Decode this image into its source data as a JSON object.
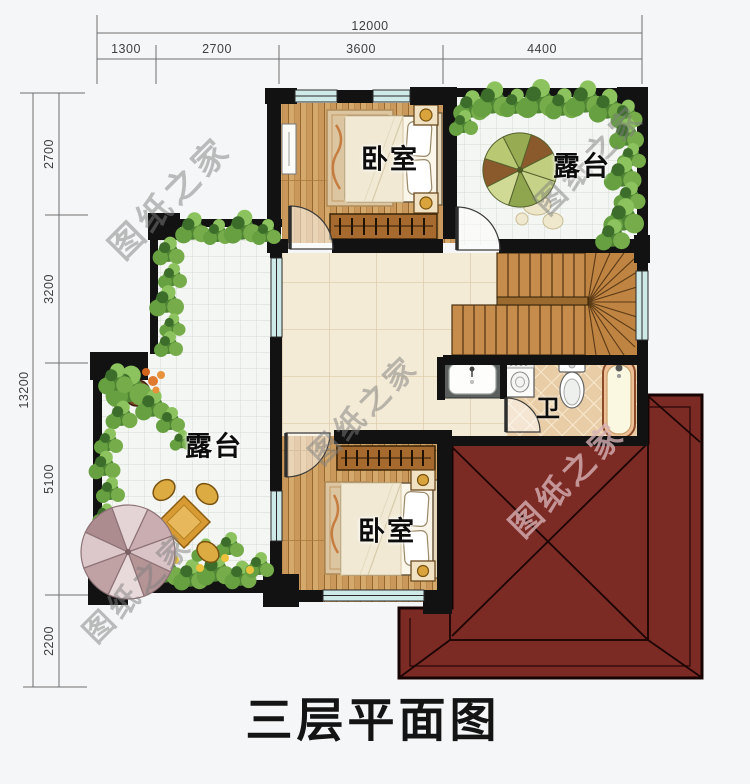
{
  "title": "三层平面图",
  "watermark": "图纸之家",
  "rooms": {
    "bedroom_top": "卧室",
    "bedroom_bottom": "卧室",
    "terrace_right": "露台",
    "terrace_left": "露台",
    "bathroom": "卫"
  },
  "dimensions": {
    "top": {
      "total": "12000",
      "segments": [
        "1300",
        "2700",
        "3600",
        "4400"
      ]
    },
    "left": {
      "total": "13200",
      "segments": [
        "2700",
        "3200",
        "5100",
        "2200"
      ]
    }
  },
  "colors": {
    "roof": "#7c2a24",
    "wall": "#121212",
    "wood_floor": "#c9985a",
    "hall_tile": "#f4ebd7",
    "terrace_tile": "#f4f6f3",
    "bath_tile": "#e9cda6",
    "window": "#cdeae8",
    "background": "#f5f6f7"
  }
}
